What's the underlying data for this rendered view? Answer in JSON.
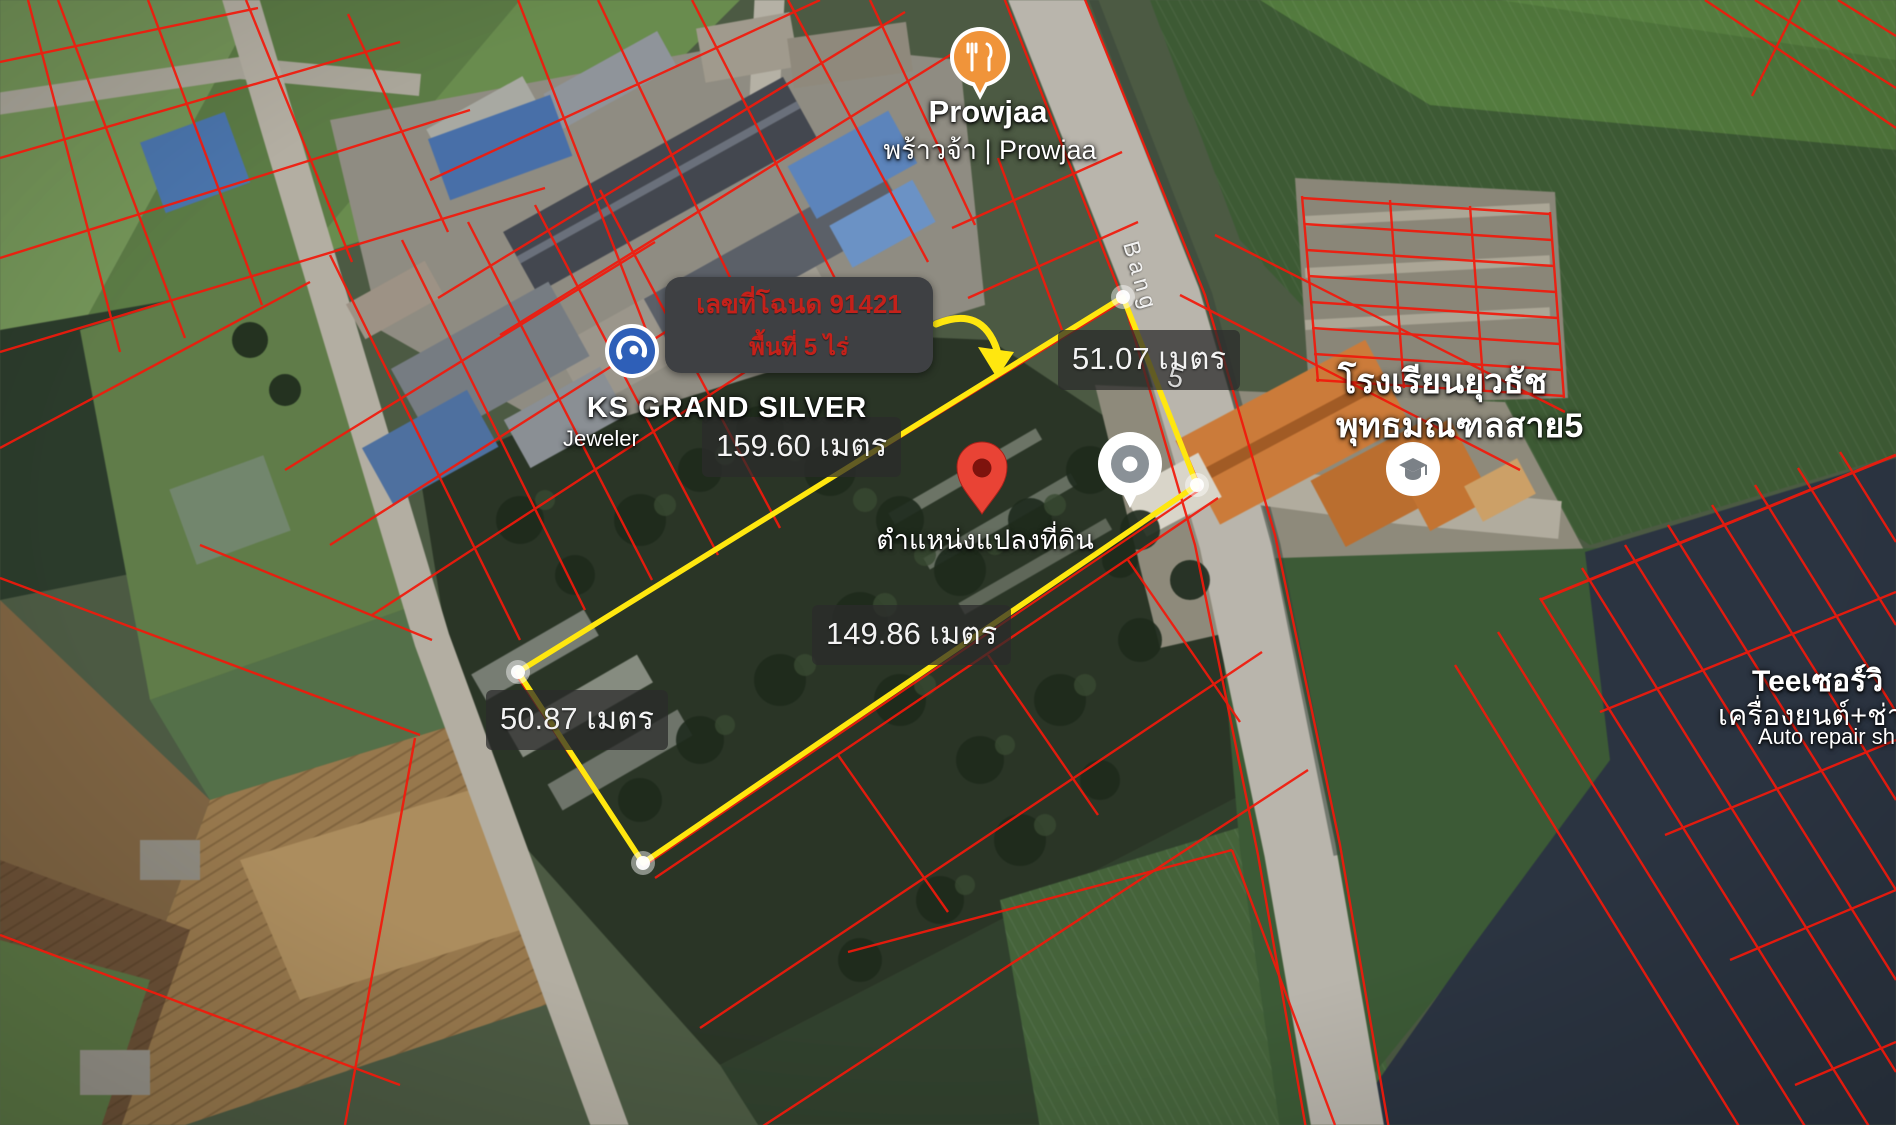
{
  "tooltip": {
    "deed_line": "เลขที่โฉนด 91421",
    "area_line": "พื้นที่ 5 ไร่"
  },
  "measurements": {
    "top": "159.60 เมตร",
    "right_side": "51.07 เมตร",
    "bottom": "149.86 เมตร",
    "left_side": "50.87 เมตร"
  },
  "markers": {
    "restaurant": {
      "name": "Prowjaa",
      "subtitle": "พร้าวจ้า | Prowjaa",
      "icon": "restaurant-icon"
    },
    "jeweler": {
      "name": "KS GRAND SILVER",
      "subtitle": "Jeweler",
      "icon": "ks-logo-icon"
    },
    "land_pin": {
      "label": "ตำแหน่งแปลงที่ดิน",
      "icon": "red-map-pin-icon"
    },
    "point_marker": {
      "icon": "circle-dot-marker-icon"
    },
    "school": {
      "name_line1": "โรงเรียนยุวธัช",
      "name_line2": "พุทธมณฑลสาย5",
      "icon": "school-icon"
    },
    "auto_repair": {
      "name_line1": "Teeเซอร์วิ",
      "name_line2": "เครื่องยนต์+ช่างล่",
      "name_line3": "Auto repair sh"
    }
  },
  "road": {
    "name_partial": "Bang",
    "route_number": "5"
  },
  "colors": {
    "parcel_line": "#f2190b",
    "highlight_polygon": "#ffe70f",
    "tooltip_bg": "#3e4043",
    "tooltip_text": "#c4211a",
    "label_bg": "#2b2b2b",
    "restaurant_pin": "#f0943a",
    "land_pin": "#e94335"
  }
}
